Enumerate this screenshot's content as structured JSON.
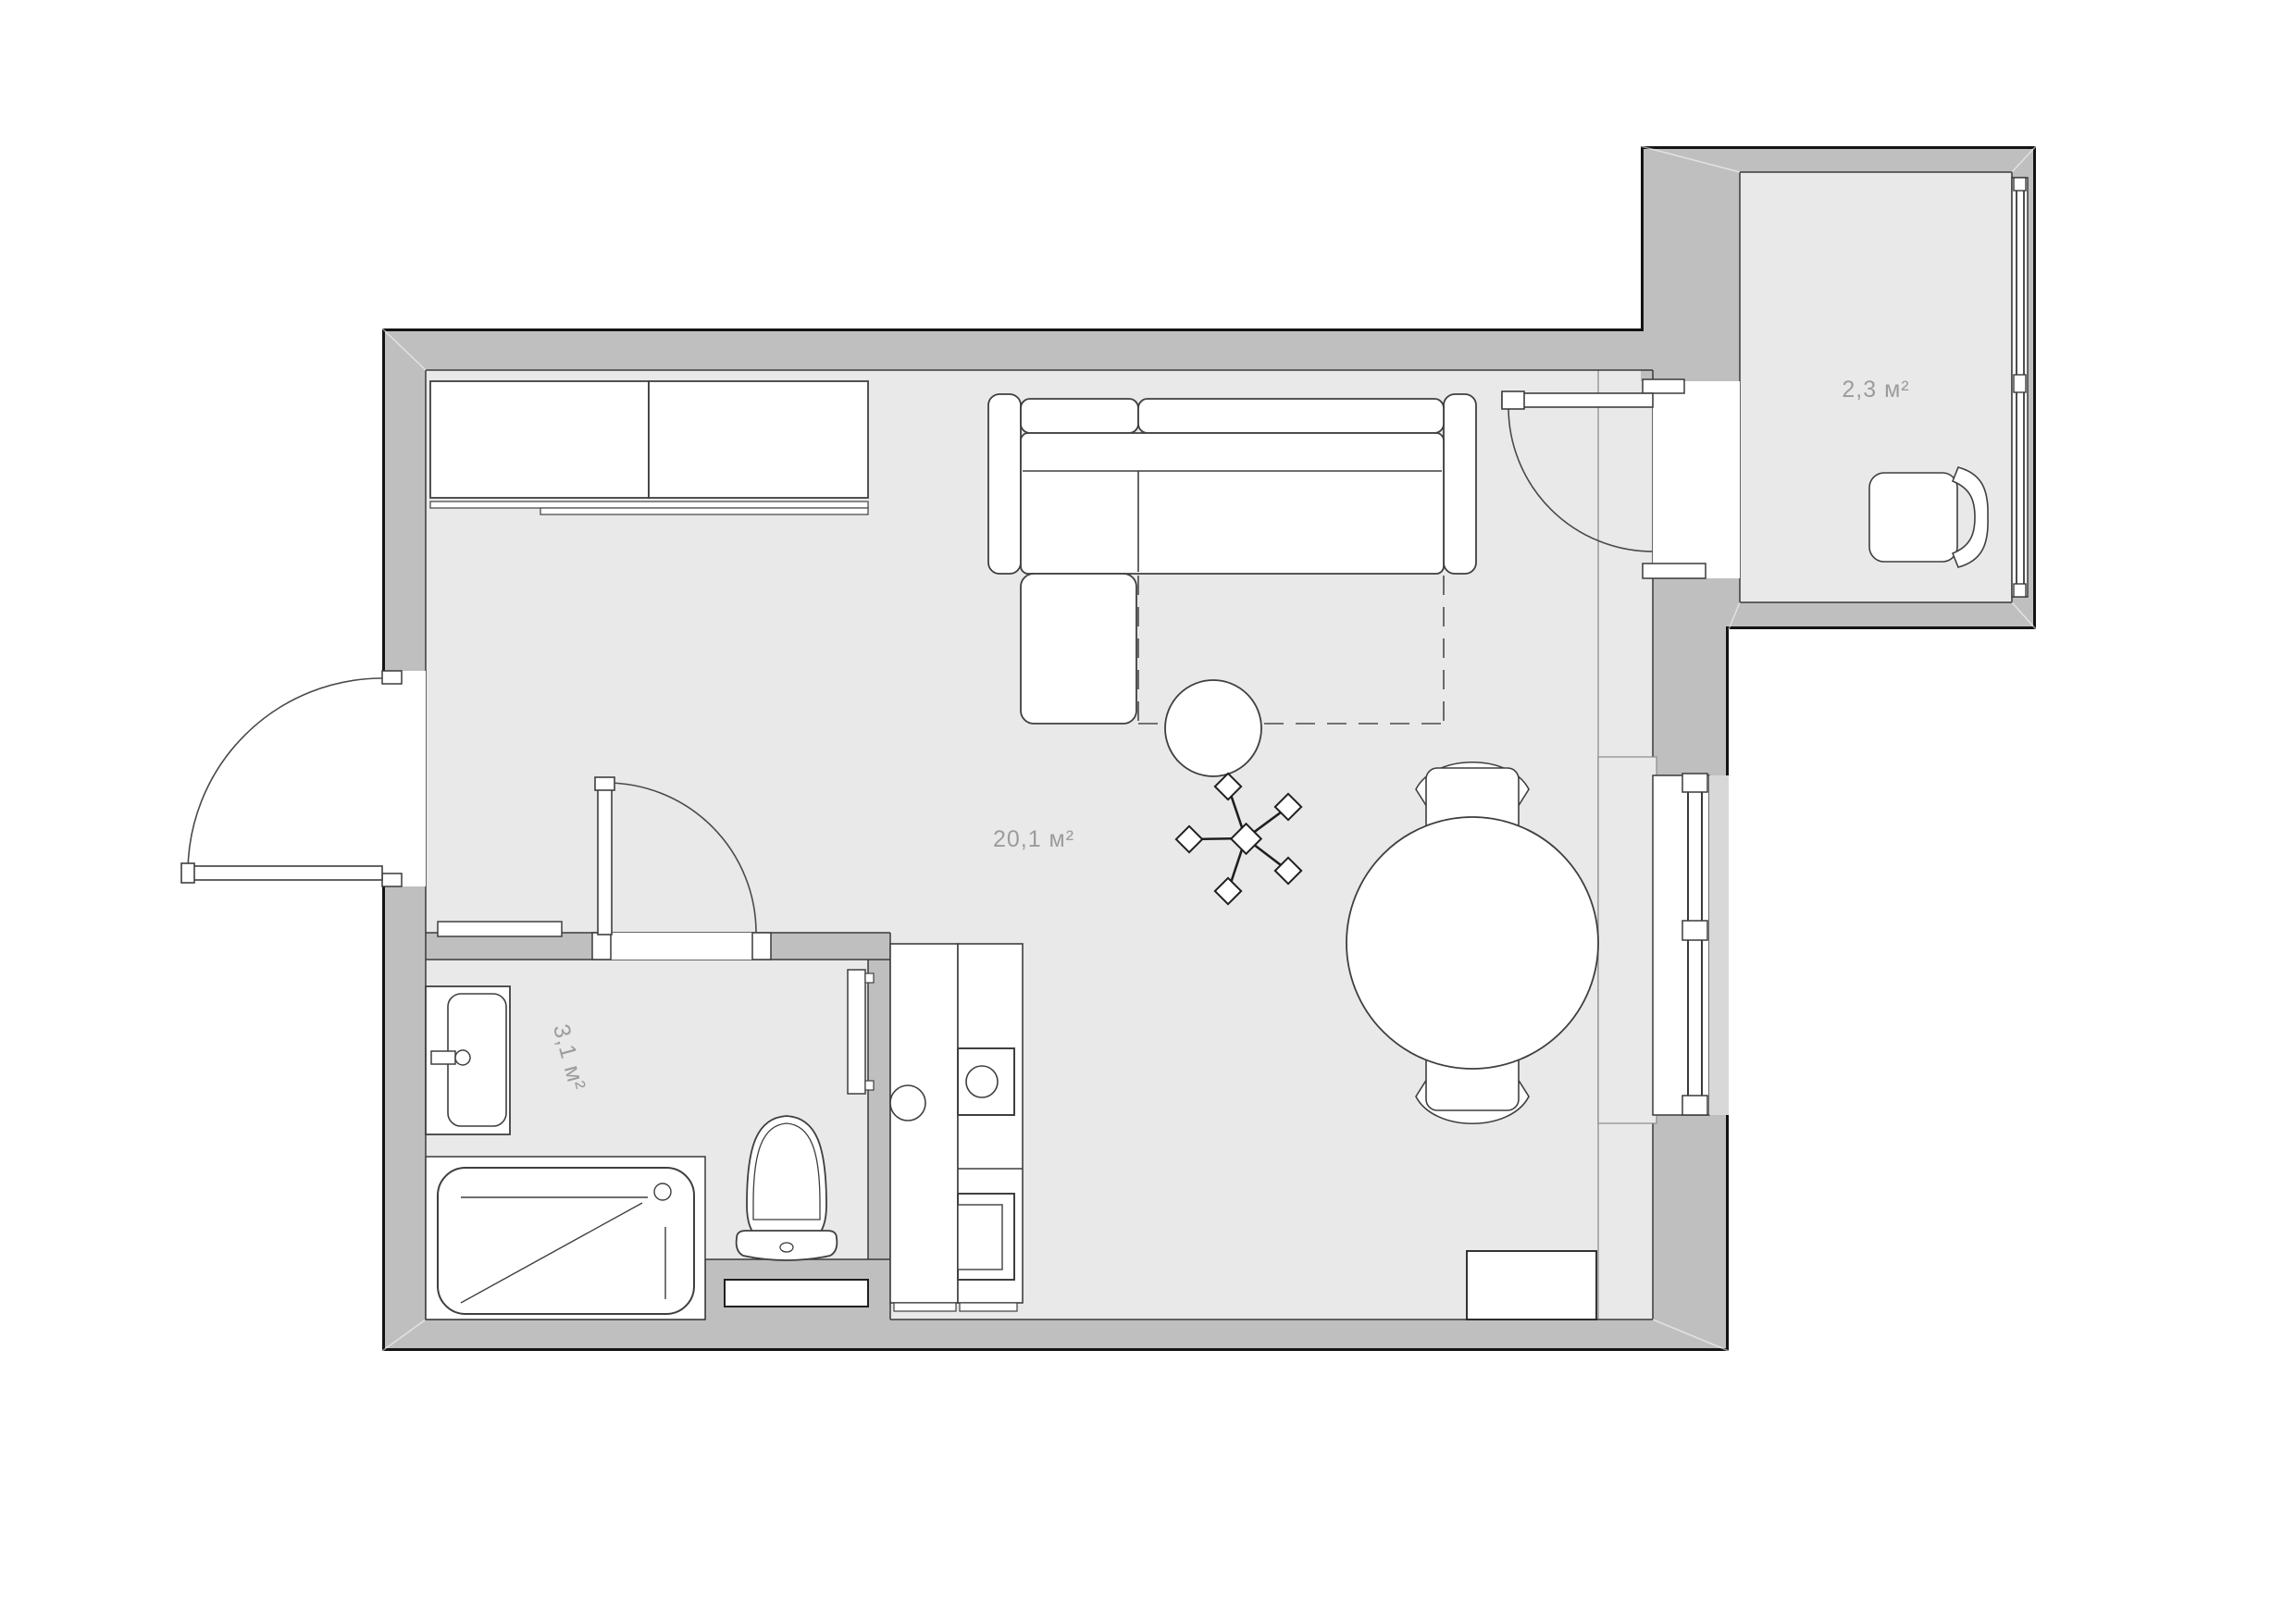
{
  "plan": {
    "title": "Studio apartment floor plan",
    "colors": {
      "background": "#ffffff",
      "wall_fill": "#bfbfbf",
      "floor_fill": "#e9e9e9",
      "outer_outline": "#141414",
      "inner_line": "#3a3a3a",
      "furniture_line": "#3f3f3f",
      "label_text": "#9c9c9c"
    },
    "rooms": [
      {
        "id": "living-kitchen",
        "name": "living room with kitchen",
        "area_label": "20,1 м²"
      },
      {
        "id": "bathroom",
        "name": "bathroom",
        "area_label": "3,1 м²"
      },
      {
        "id": "balcony",
        "name": "balcony",
        "area_label": "2,3 м²"
      }
    ],
    "elements": [
      "sliding-wardrobe",
      "corner-sofa",
      "sofa-bed-dashed-outline",
      "pouf-table",
      "ceiling-fan-symbol",
      "round-dining-table",
      "dining-chair",
      "dining-chair",
      "kitchen-counter",
      "cooktop",
      "oven",
      "sink-vanity",
      "bathtub",
      "toilet",
      "towel-rail",
      "entrance-door",
      "bathroom-door",
      "balcony-door",
      "window",
      "balcony-window",
      "balcony-chair",
      "low-cabinet",
      "wall-shelf"
    ]
  }
}
